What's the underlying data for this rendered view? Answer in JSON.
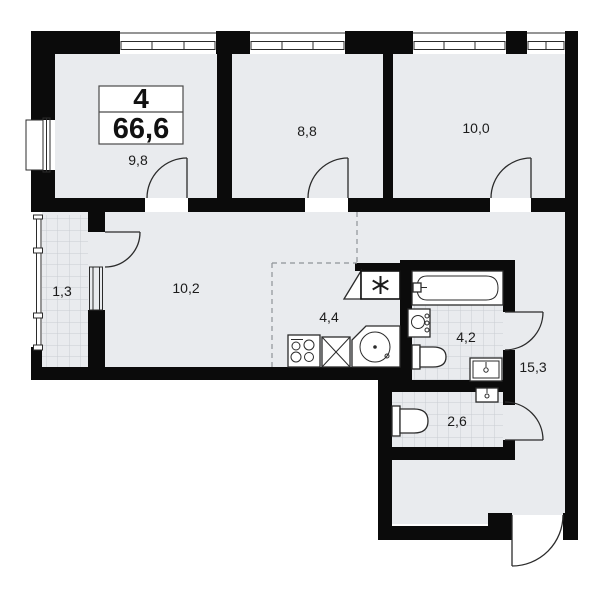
{
  "title": "Apartment floor plan",
  "unit": {
    "rooms_count": "4",
    "total_area": "66,6"
  },
  "rooms": {
    "bedroom1": {
      "area": "9,8"
    },
    "bedroom2": {
      "area": "8,8"
    },
    "bedroom3": {
      "area": "10,0"
    },
    "balcony": {
      "area": "1,3"
    },
    "hall": {
      "area": "10,2"
    },
    "kitchen": {
      "area": "4,4"
    },
    "bathroom": {
      "area": "4,2"
    },
    "corridor": {
      "area": "15,3"
    },
    "wc": {
      "area": "2,6"
    }
  },
  "colors": {
    "wall": "#0b0b0b",
    "floor": "#e9ebee",
    "tile_grid": "#c9cdd2",
    "outline": "#2b2b2b",
    "dashed_zone": "#8f9397",
    "background": "#ffffff"
  }
}
